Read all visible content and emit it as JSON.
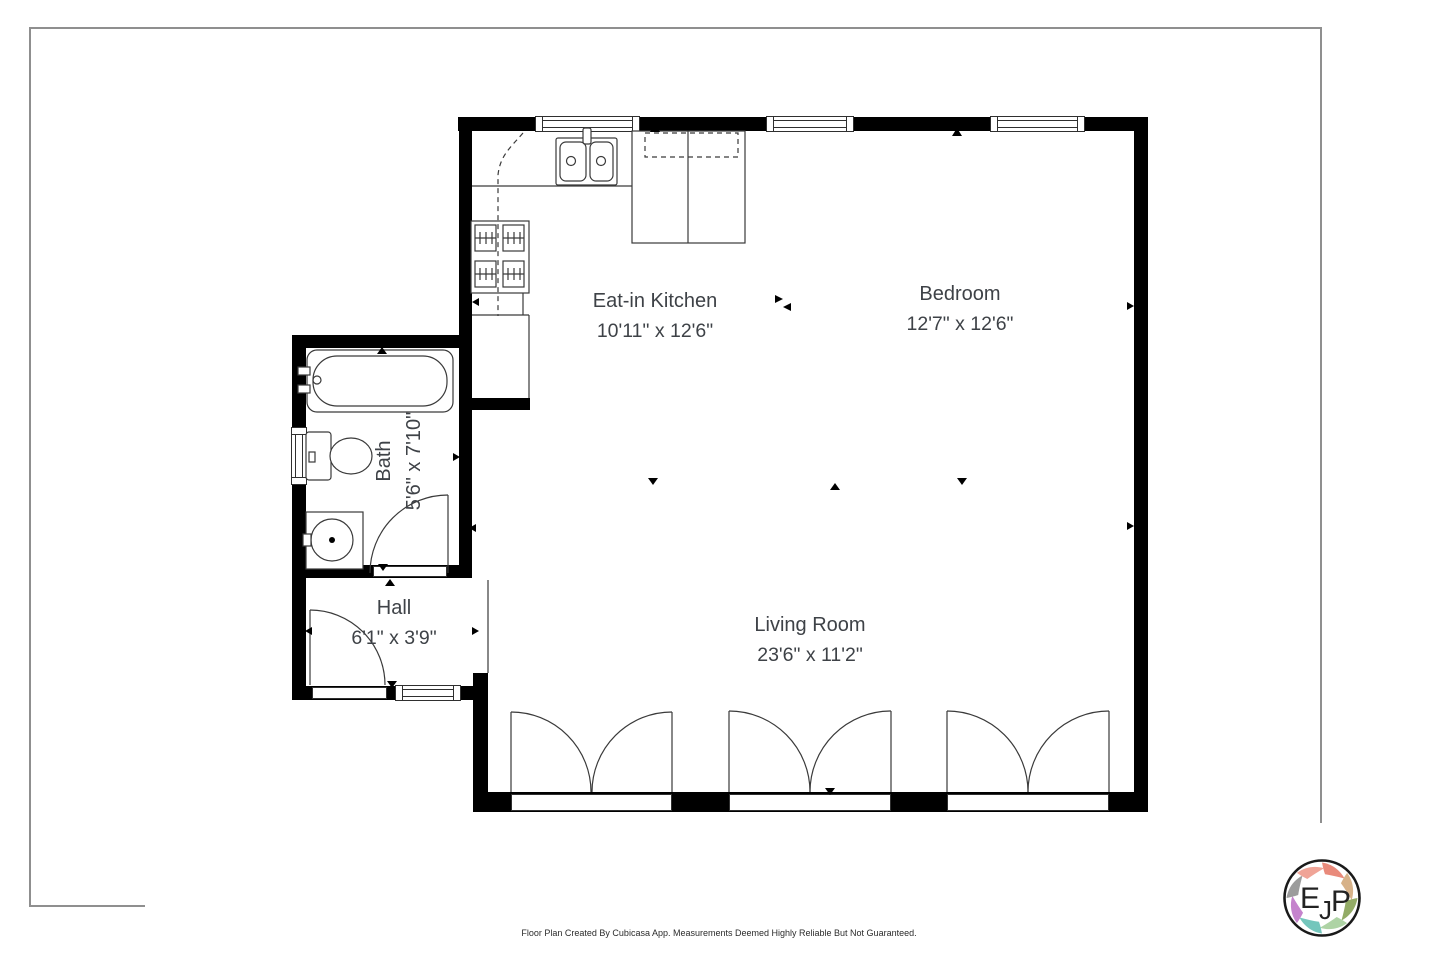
{
  "canvas": {
    "width": 1440,
    "height": 959,
    "background": "#ffffff"
  },
  "plan": {
    "wall_color": "#000000",
    "line_color": "#3a3a3a",
    "label_color": "#3e4247",
    "rooms": [
      {
        "name": "Eat-in Kitchen",
        "dimensions": "10'11\" x 12'6\""
      },
      {
        "name": "Bedroom",
        "dimensions": "12'7\" x 12'6\""
      },
      {
        "name": "Bath",
        "dimensions": "5'6\" x 7'10\""
      },
      {
        "name": "Hall",
        "dimensions": "6'1\" x 3'9\""
      },
      {
        "name": "Living Room",
        "dimensions": "23'6\" x 11'2\""
      }
    ]
  },
  "footer": {
    "disclaimer": "Floor Plan Created By Cubicasa App. Measurements Deemed Highly Reliable But Not Guaranteed."
  },
  "logo": {
    "letters": {
      "e": "E",
      "j": "J",
      "p": "P"
    },
    "petal_colors": [
      "#e98a7b",
      "#d7b289",
      "#93ab66",
      "#aed3a5",
      "#74c6bc",
      "#c583cd",
      "#9c9c9c",
      "#f0a497"
    ]
  }
}
